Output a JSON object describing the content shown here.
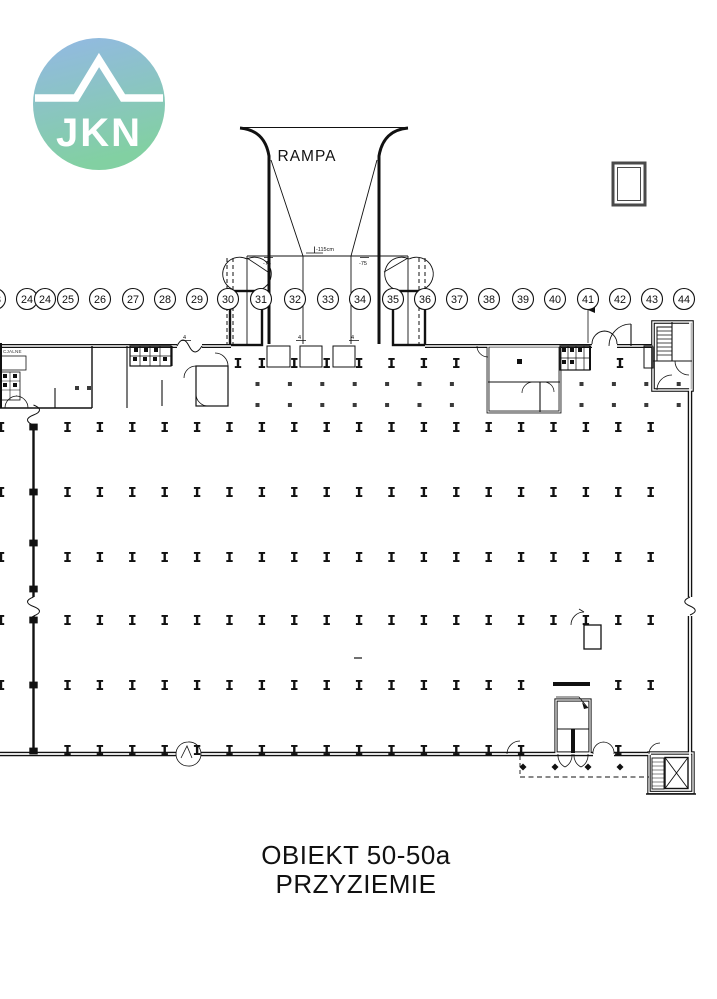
{
  "logo": {
    "text": "JKN",
    "gradient_top": "#93b8e5",
    "gradient_bottom": "#82d0a2"
  },
  "ramp": {
    "label": "RAMPA",
    "depth_annotation": "-115cm",
    "slope_left": "-75",
    "slope_right": "-75",
    "grade_mark_1": "4",
    "grade_mark_2": "4",
    "grade_mark_3": "4"
  },
  "rooms": {
    "left_room_label": "CJALNE"
  },
  "title": {
    "line1": "OBIEKT 50-50a",
    "line2": "PRZYZIEMIE"
  },
  "grid_axis": {
    "y": 299,
    "radius": 10.5,
    "bubbles": [
      {
        "label": "23",
        "x": -5
      },
      {
        "label": "24",
        "x": 27
      },
      {
        "label": "24",
        "x": 45
      },
      {
        "label": "25",
        "x": 68
      },
      {
        "label": "26",
        "x": 100
      },
      {
        "label": "27",
        "x": 133
      },
      {
        "label": "28",
        "x": 165
      },
      {
        "label": "29",
        "x": 197
      },
      {
        "label": "30",
        "x": 228
      },
      {
        "label": "31",
        "x": 261
      },
      {
        "label": "32",
        "x": 295
      },
      {
        "label": "33",
        "x": 328
      },
      {
        "label": "34",
        "x": 360
      },
      {
        "label": "35",
        "x": 393
      },
      {
        "label": "36",
        "x": 425
      },
      {
        "label": "37",
        "x": 457
      },
      {
        "label": "38",
        "x": 489
      },
      {
        "label": "39",
        "x": 523
      },
      {
        "label": "40",
        "x": 555
      },
      {
        "label": "41",
        "x": 588
      },
      {
        "label": "42",
        "x": 620
      },
      {
        "label": "43",
        "x": 652
      },
      {
        "label": "44",
        "x": 684
      }
    ]
  },
  "column_grid": {
    "x_start": 67.5,
    "x_step": 32.4,
    "x_count": 19,
    "main_rows": [
      427,
      492,
      557,
      620,
      685
    ],
    "row_skips": {
      "685": [
        548,
        596
      ]
    },
    "wall_row": {
      "y": 750,
      "skip": [
        548,
        600
      ],
      "x_max": 640
    },
    "top_i_row": {
      "y": 363,
      "xs": [
        238,
        261.9,
        294.3,
        326.7,
        359.1,
        391.5,
        423.9,
        456.3,
        620
      ]
    },
    "square_rows": [
      384,
      405
    ],
    "square_x_start": 257.5,
    "square_x_step": 32.4,
    "square_x_count": 14,
    "square_skip": [
      481,
      567
    ],
    "extra_squares": [
      [
        77,
        388
      ],
      [
        89,
        388
      ]
    ],
    "left_edge_x": 1,
    "left_wall": {
      "x": 33.5,
      "ys": [
        427,
        492,
        543,
        589,
        620,
        685,
        751
      ]
    },
    "diamonds": {
      "y": 767,
      "xs": [
        523,
        555,
        588,
        620
      ]
    }
  }
}
